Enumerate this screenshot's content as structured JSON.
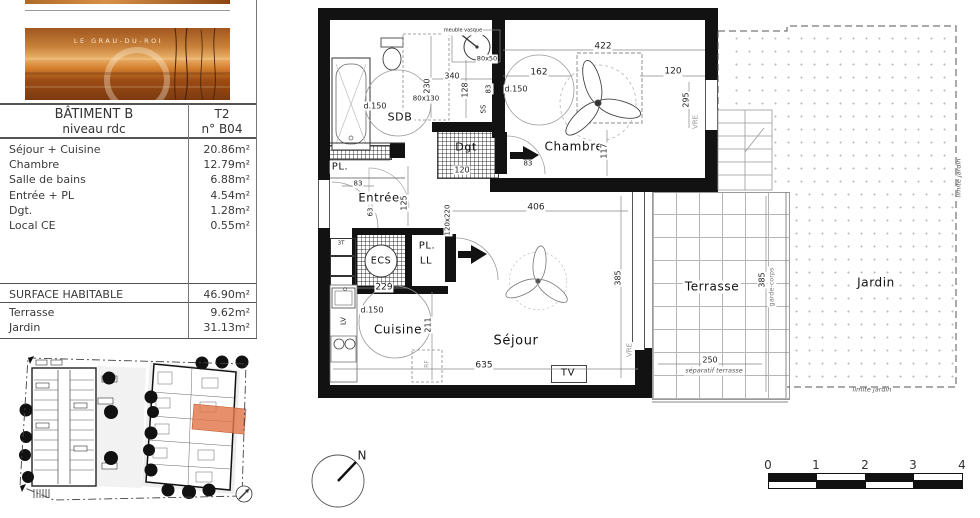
{
  "panel": {
    "banner": {
      "location": "LE GRAU-DU-ROI"
    },
    "header": {
      "building": "BÂTIMENT B",
      "level": "niveau rdc",
      "type": "T2",
      "unit": "n° B04"
    },
    "rooms": [
      {
        "label": "Séjour + Cuisine",
        "area": "20.86m²"
      },
      {
        "label": "Chambre",
        "area": "12.79m²"
      },
      {
        "label": "Salle de bains",
        "area": "6.88m²"
      },
      {
        "label": "Entrée + PL",
        "area": "4.54m²"
      },
      {
        "label": "Dgt.",
        "area": "1.28m²"
      },
      {
        "label": "Local CE",
        "area": "0.55m²"
      }
    ],
    "surface": {
      "label": "SURFACE HABITABLE",
      "value": "46.90m²"
    },
    "exterior": [
      {
        "label": "Terrasse",
        "value": "9.62m²"
      },
      {
        "label": "Jardin",
        "value": "31.13m²"
      }
    ]
  },
  "plan": {
    "labels": {
      "sdb": "SDB",
      "dgt": "Dgt",
      "chambre": "Chambre",
      "entree": "Entrée",
      "pl": "PL.",
      "ll": "LL",
      "ecs": "ECS",
      "cuisine": "Cuisine",
      "sejour": "Séjour",
      "terrasse": "Terrasse",
      "jardin": "Jardin",
      "tv": "TV",
      "t3": "3T",
      "d150": "d.150",
      "vre": "VRE",
      "ss": "SS",
      "lv": "LV",
      "rf": "RF",
      "meuble_vasque": "meuble vasque",
      "s80x50": "80x50",
      "s80x130": "80x130",
      "s120x220": "120x220",
      "n340": "340",
      "n230": "230",
      "n128": "128",
      "n83": "83",
      "n63": "63",
      "n125": "125",
      "n120": "120",
      "n422": "422",
      "n162": "162",
      "n295": "295",
      "n117": "117",
      "n406": "406",
      "n229": "229",
      "n211": "211",
      "n635": "635",
      "n385": "385",
      "n250": "250",
      "garde_corps": "garde-corps",
      "separatif": "séparatif terrasse",
      "limite_jardin": "limite jardin",
      "north": "N"
    },
    "scale": [
      "0",
      "1",
      "2",
      "3",
      "4"
    ],
    "colors": {
      "highlight": "#e2764b",
      "wall": "#121212"
    }
  }
}
